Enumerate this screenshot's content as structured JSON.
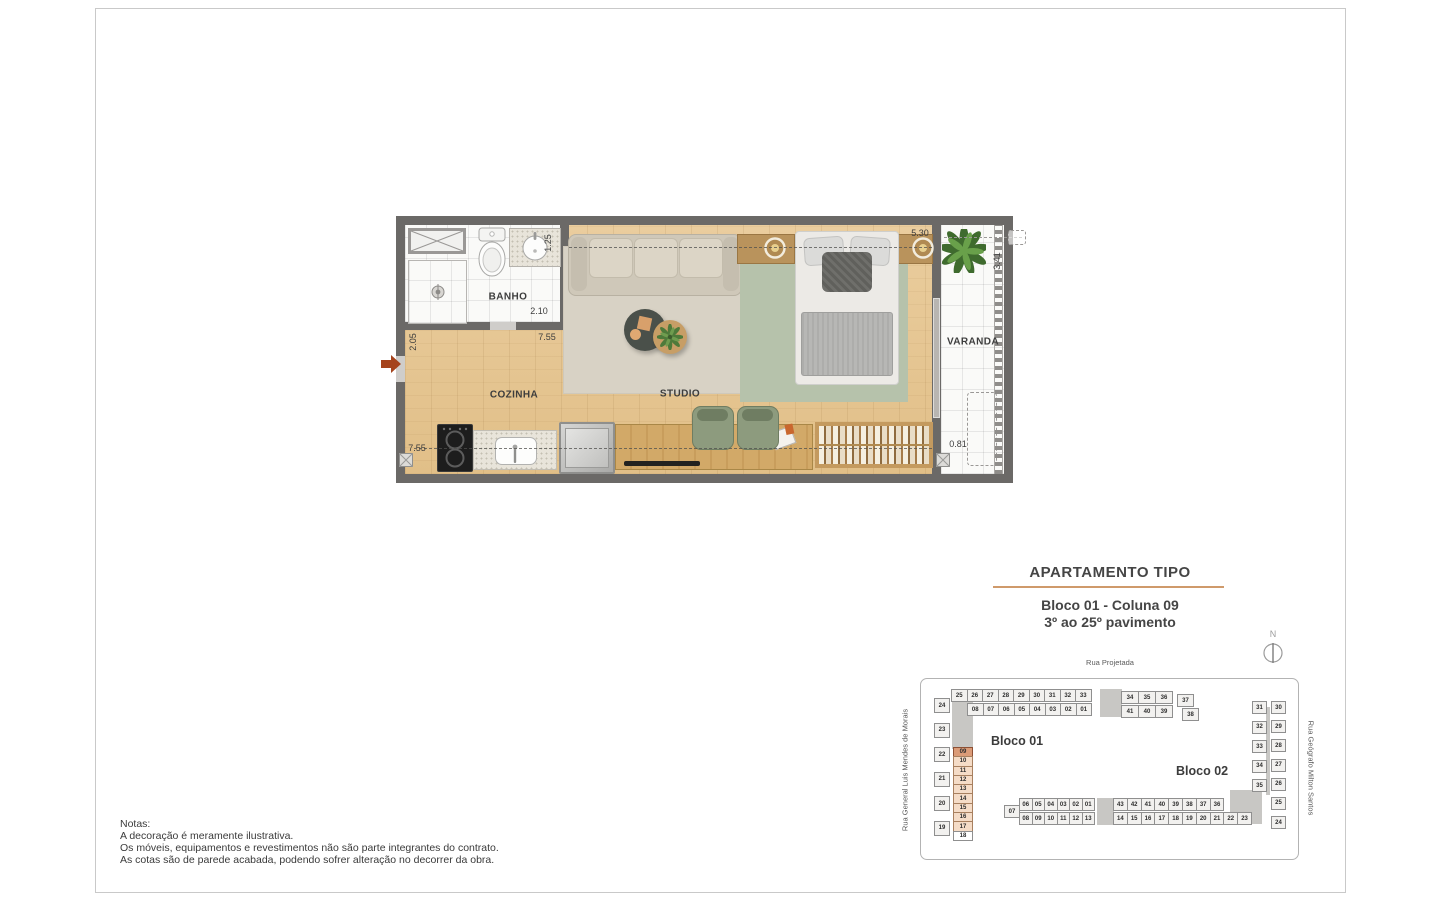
{
  "floor_plan": {
    "rooms": {
      "banho": "BANHO",
      "cozinha": "COZINHA",
      "studio": "STUDIO",
      "varanda": "VARANDA"
    },
    "dims": {
      "banho_sink_depth": "1.25",
      "banho_width": "2.10",
      "entry_wall": "2.05",
      "top_width": "7.55",
      "bottom_width": "7.55",
      "bed_wall": "5.30",
      "varanda_depth": "3.41",
      "varanda_width": "0.81"
    }
  },
  "title_block": {
    "title": "APARTAMENTO TIPO",
    "subtitle_line1": "Bloco 01 - Coluna 09",
    "subtitle_line2": "3º ao 25º pavimento"
  },
  "compass": {
    "north_label": "N"
  },
  "site_plan": {
    "street_top": "Rua Projetada",
    "street_left": "Rua General Luis Mendes de Morais",
    "street_right": "Rua Geógrafo Milton Santos",
    "bloco01": {
      "label": "Bloco 01",
      "highlighted_unit": "09",
      "top_row1": [
        "25",
        "26",
        "27",
        "28",
        "29",
        "30",
        "31",
        "32",
        "33"
      ],
      "top_row1b": [
        "34",
        "35",
        "36"
      ],
      "unit_37": "37",
      "unit_38": "38",
      "top_row2": [
        "08",
        "07",
        "06",
        "05",
        "04",
        "03",
        "02",
        "01"
      ],
      "top_row2b": [
        "41",
        "40",
        "39"
      ],
      "left_col": [
        "24",
        "23",
        "22",
        "21",
        "20",
        "19"
      ],
      "inner_col": [
        "09",
        "10",
        "11",
        "12",
        "13",
        "14",
        "15",
        "16",
        "17",
        "18"
      ]
    },
    "bloco02": {
      "label": "Bloco 02",
      "right_col_inner": [
        "31",
        "32",
        "33",
        "34",
        "35"
      ],
      "right_col_outer": [
        "30",
        "29",
        "28",
        "27",
        "26",
        "25",
        "24"
      ],
      "unit_07": "07",
      "bottom_row1": [
        "06",
        "05",
        "04",
        "03",
        "02",
        "01"
      ],
      "bottom_row1b": [
        "43",
        "42",
        "41",
        "40",
        "39",
        "38",
        "37",
        "36"
      ],
      "bottom_row2": [
        "08",
        "09",
        "10",
        "11",
        "12",
        "13"
      ],
      "bottom_row2b": [
        "14",
        "15",
        "16",
        "17",
        "18",
        "19",
        "20",
        "21",
        "22",
        "23"
      ]
    }
  },
  "notes": {
    "heading": "Notas:",
    "line1": "A decoração é meramente ilustrativa.",
    "line2": "Os móveis, equipamentos e revestimentos não são parte integrantes do contrato.",
    "line3": "As cotas são de parede acabada, podendo sofrer alteração no decorrer da obra."
  },
  "colors": {
    "wall": "#6b6967",
    "accent_underline": "#cf9a6b",
    "highlight_dark": "#db9b77",
    "highlight_light": "#f5dcc7",
    "entry_arrow": "#a5431c"
  }
}
